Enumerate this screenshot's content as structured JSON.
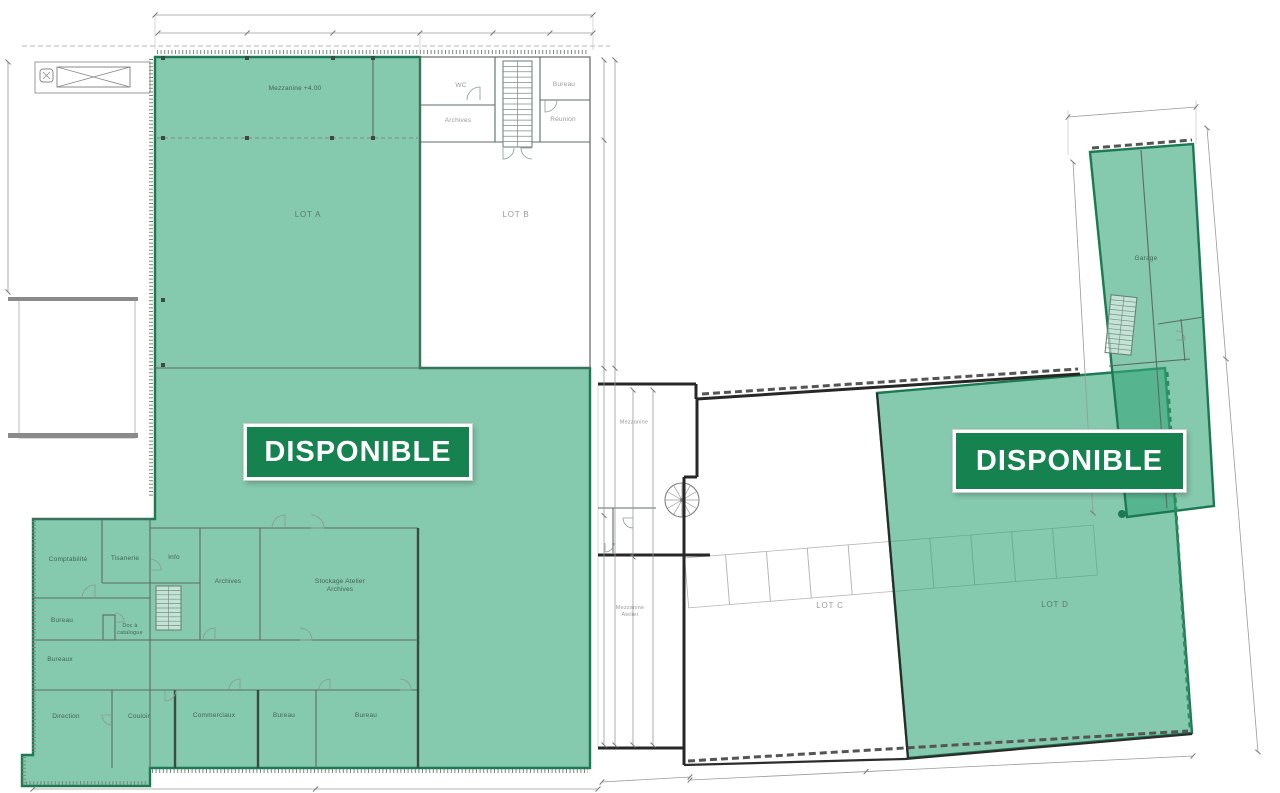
{
  "banners": {
    "left": "DISPONIBLE",
    "right": "DISPONIBLE"
  },
  "lots": {
    "lot_a": "LOT A",
    "lot_b": "LOT B",
    "lot_c": "LOT C",
    "lot_d": "LOT D"
  },
  "rooms": {
    "mezzanine_hall": "Mezzanine +4.00",
    "wc": "WC",
    "bureau_top": "Bureau",
    "archives_top": "Archives",
    "reunion": "Réunion",
    "comptabilite": "Comptabilité",
    "tisanerie": "Tisanerie",
    "info": "Info",
    "archives_mid": "Archives",
    "stockage": "Stockage Atelier\nArchives",
    "bureau_left": "Bureau",
    "doc_catalogue": "Doc à\ncatalogue",
    "bureaux_left": "Bureaux",
    "direction": "Direction",
    "couloir": "Couloir",
    "commerciaux": "Commerciaux",
    "bureau_bottom_1": "Bureau",
    "bureau_bottom_2": "Bureau",
    "mezzanine_conn": "Mezzanine",
    "mezzanine_atelier": "Mezzanine\nAtelier",
    "garage": "Garage"
  },
  "colors": {
    "highlight_green": "#85c7ad",
    "highlight_green_overlap": "#56bf8f",
    "banner_green": "#16824f",
    "outline_green": "#1c7a52",
    "wall_dark": "#272727",
    "wall_gray": "#5d6b64",
    "dim_gray": "#9a9a9a"
  }
}
